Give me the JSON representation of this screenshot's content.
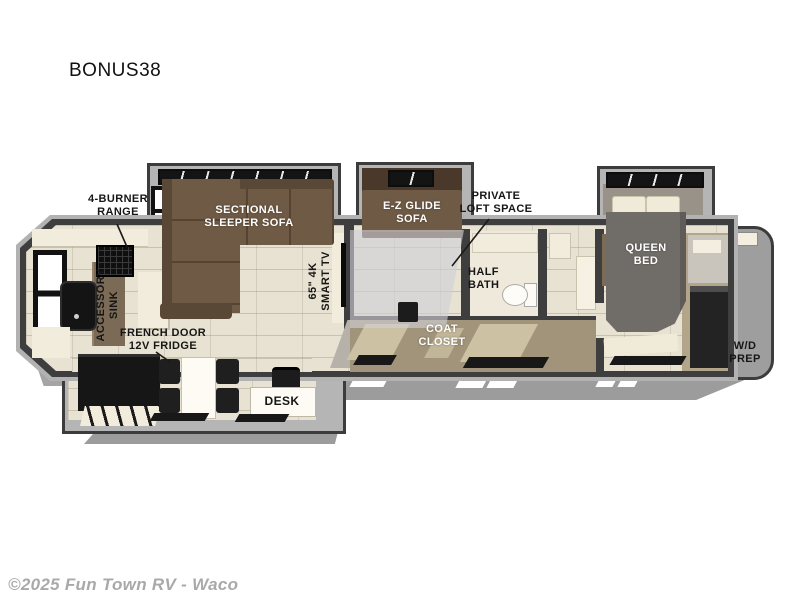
{
  "title": "BONUS38",
  "footer": {
    "copyright": "©2025 Fun Town RV - Waco"
  },
  "colors": {
    "wall": "#3e3e3e",
    "shell_gray": "#b2b2b2",
    "floor_tile": "#e8e2d2",
    "sofa_brown": "#6f5a45",
    "closet_tan": "#a1947a",
    "label_black": "#161616",
    "label_white": "#ffffff",
    "copyright_gray": "#a9a9a9"
  },
  "labels": {
    "range": "4-BURNER\nRANGE",
    "sectional": "SECTIONAL\nSLEEPER SOFA",
    "ez_glide": "E-Z GLIDE\nSOFA",
    "loft": "PRIVATE\nLOFT SPACE",
    "half_bath": "HALF\nBATH",
    "queen_bed": "QUEEN\nBED",
    "smart_tv": "65\" 4K\nSMART TV",
    "accessory_sink": "ACCESSORY\nSINK",
    "fridge": "FRENCH DOOR\n12V FRIDGE",
    "coat_closet": "COAT\nCLOSET",
    "desk": "DESK",
    "wd_prep": "W/D\nPREP"
  }
}
